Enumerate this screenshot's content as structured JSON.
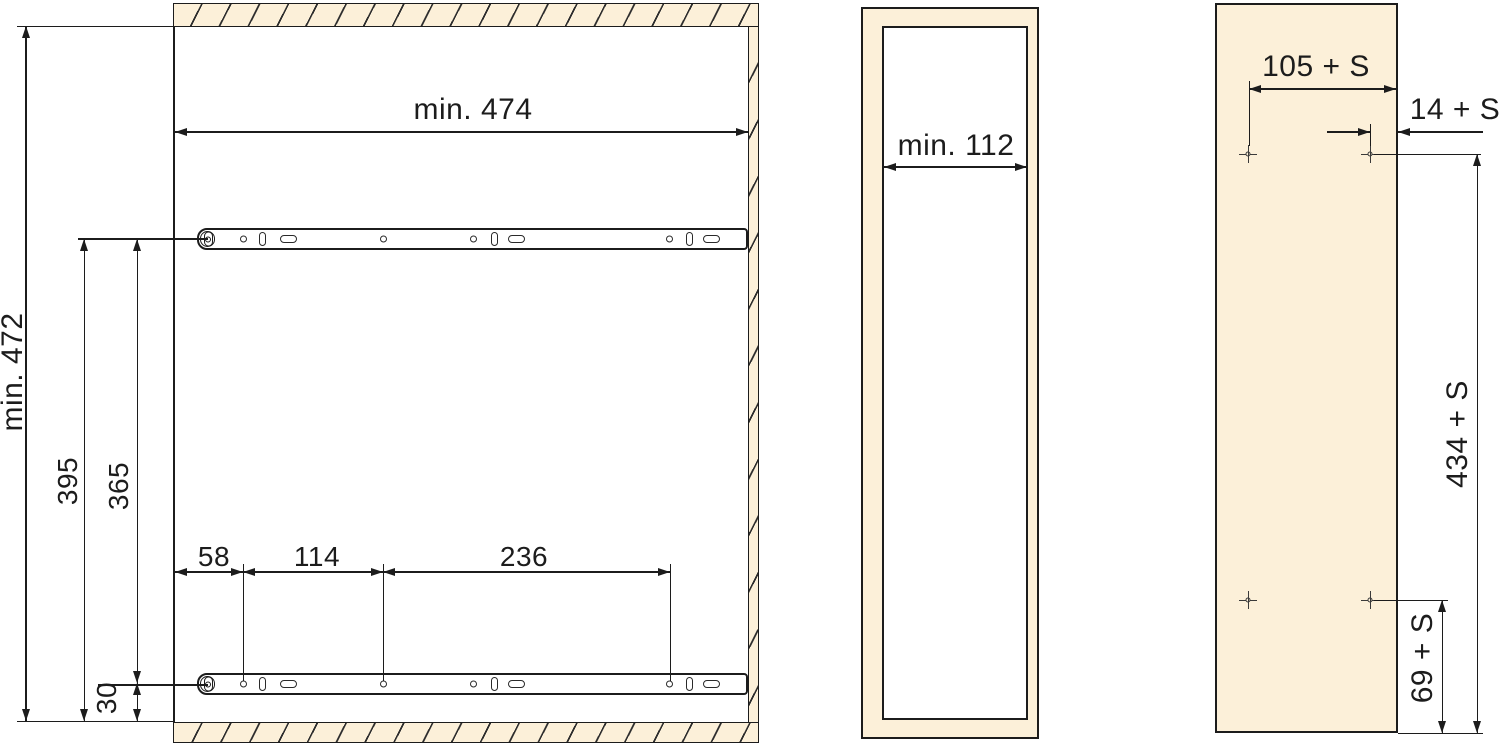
{
  "colors": {
    "panel_fill": "#fcf0d9",
    "line": "#1c1c1c",
    "background": "#ffffff"
  },
  "views": {
    "cabinet_section": {
      "inner_width_label": "min. 474",
      "inner_height_label": "min. 472",
      "top_rail_to_bottom_label": "395",
      "rail_to_rail_label": "365",
      "bottom_rail_offset_label": "30",
      "front_hole_offset_label": "58",
      "hole_pitch_1_label": "114",
      "hole_pitch_2_label": "236"
    },
    "module_front": {
      "inner_width_label": "min. 112"
    },
    "mounting_panel": {
      "top_holes_span_label": "105 + S",
      "edge_to_hole_label": "14 + S",
      "holes_vertical_span_label": "434 + S",
      "bottom_hole_offset_label": "69 + S"
    }
  }
}
